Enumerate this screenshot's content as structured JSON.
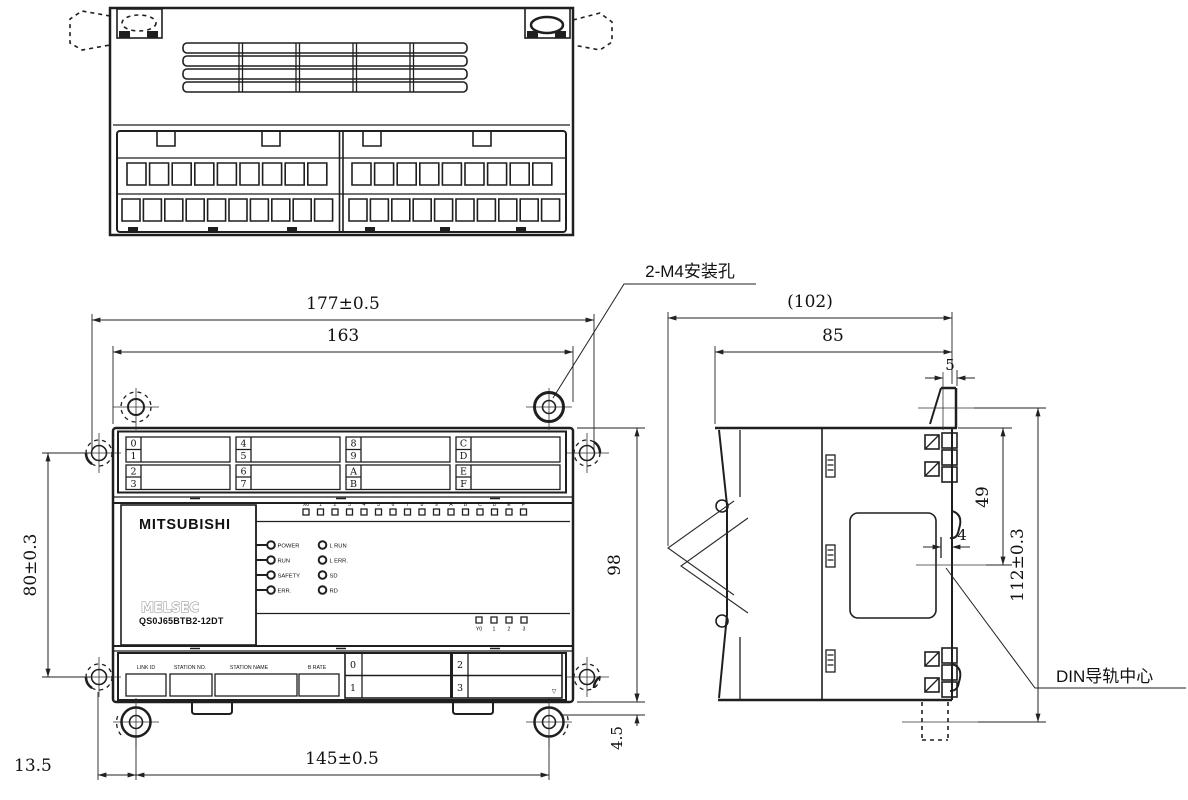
{
  "drawing": {
    "callouts": {
      "mounting_holes": "2-M4安装孔",
      "din_rail_center": "DIN导轨中心"
    },
    "dimensions": {
      "overall_width": "177±0.5",
      "body_width": "163",
      "hole_pitch_vertical": "80±0.3",
      "body_height": "98",
      "foot_height": "4.5",
      "hole_pitch_horizontal": "145±0.5",
      "hole_edge_offset": "13.5",
      "overall_depth": "(102)",
      "body_depth": "85",
      "hook_width": "5",
      "rail_center_offset": "49",
      "groove_depth": "4",
      "overall_height": "112±0.3"
    },
    "front_view": {
      "brand": "MITSUBISHI",
      "series_logo": "MELSEC",
      "model": "QS0J65BTB2-12DT",
      "status_leds_left": [
        "POWER",
        "RUN",
        "SAFETY",
        "ERR."
      ],
      "status_leds_right": [
        "L RUN",
        "L ERR.",
        "SD",
        "RD"
      ],
      "input_leds": [
        "X0",
        "1",
        "2",
        "3",
        "4",
        "5",
        "6",
        "7",
        "8",
        "9",
        "A",
        "B",
        "C",
        "D",
        "E",
        "F"
      ],
      "output_leds": [
        "Y0",
        "1",
        "2",
        "3"
      ],
      "terminal_labels": [
        [
          "0",
          "1",
          "2",
          "3"
        ],
        [
          "4",
          "5",
          "6",
          "7"
        ],
        [
          "8",
          "9",
          "A",
          "B"
        ],
        [
          "C",
          "D",
          "E",
          "F"
        ]
      ],
      "setting_fields": [
        "LINK ID",
        "STATION NO.",
        "STATION NAME",
        "B RATE"
      ],
      "setting_cells": [
        "0",
        "1",
        "2",
        "3"
      ],
      "delta_mark": "▽"
    }
  }
}
